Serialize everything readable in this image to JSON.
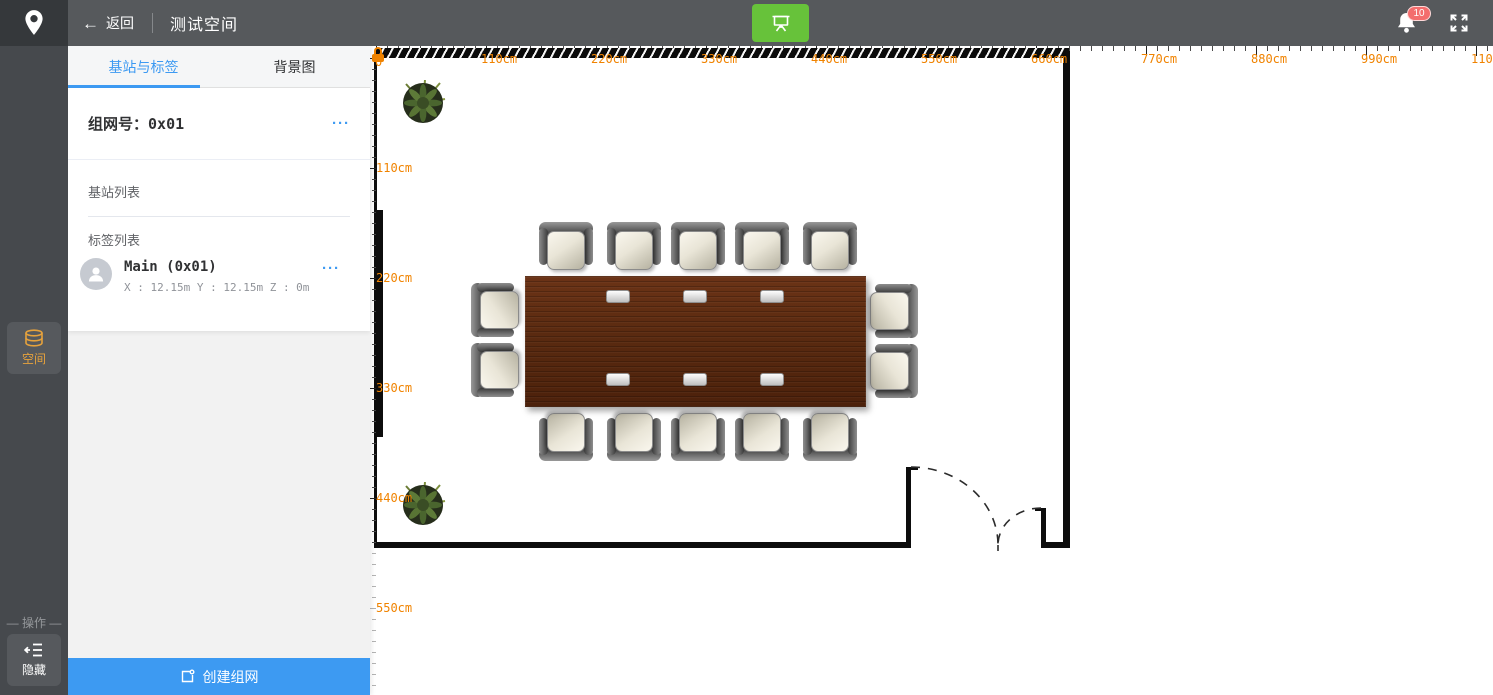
{
  "topbar": {
    "back_label": "返回",
    "title": "测试空间",
    "badge_count": "10"
  },
  "sidebar": {
    "space_label": "空间",
    "operation_label": "— 操作 —",
    "hide_label": "隐藏"
  },
  "panel": {
    "tabs": [
      {
        "label": "基站与标签",
        "active": true
      },
      {
        "label": "背景图",
        "active": false
      }
    ],
    "network_label": "组网号：",
    "network_value": "0x01",
    "menu_ellipsis": "···",
    "station_list_label": "基站列表",
    "tag_list_label": "标签列表",
    "tags": [
      {
        "name": "Main (0x01)",
        "coords": "X : 12.15m Y : 12.15m Z : 0m"
      }
    ],
    "create_button_label": "创建组网"
  },
  "colors": {
    "accent_blue": "#3d9af2",
    "sidebar_orange": "#e6a23c",
    "ruler_orange": "#f08300",
    "success_green": "#67c23a",
    "badge_red": "#f36d6d"
  },
  "floorplan": {
    "origin": {
      "x": 6,
      "y": 12,
      "label": "0"
    },
    "ruler": {
      "minor_px": 11,
      "major_every": 10,
      "step_cm": 110,
      "px_per_cm": 1,
      "h_labels": [
        "110cm",
        "220cm",
        "330cm",
        "440cm",
        "550cm",
        "660cm",
        "770cm",
        "880cm",
        "990cm",
        "1100cm"
      ],
      "v_labels": [
        "110cm",
        "220cm",
        "330cm",
        "440cm",
        "550cm"
      ]
    },
    "room_bottom_y": 502,
    "walls": [
      {
        "name": "wall-top-hatched",
        "x": 6,
        "y": 2,
        "w": 690,
        "h": 10,
        "hatch": true
      },
      {
        "name": "wall-left",
        "x": 4,
        "y": 12,
        "w": 3,
        "h": 490
      },
      {
        "name": "wall-left-thick-segment",
        "x": 4,
        "y": 164,
        "w": 9,
        "h": 227
      },
      {
        "name": "wall-right",
        "x": 693,
        "y": 2,
        "w": 7,
        "h": 500
      },
      {
        "name": "wall-bottom-left",
        "x": 4,
        "y": 496,
        "w": 537,
        "h": 6
      },
      {
        "name": "wall-bottom-right",
        "x": 671,
        "y": 496,
        "w": 29,
        "h": 6
      },
      {
        "name": "door-jamb-left",
        "x": 536,
        "y": 421,
        "w": 5,
        "h": 81
      },
      {
        "name": "door-jamb-left-cap",
        "x": 536,
        "y": 421,
        "w": 12,
        "h": 3
      },
      {
        "name": "door-jamb-right",
        "x": 671,
        "y": 462,
        "w": 5,
        "h": 40
      },
      {
        "name": "door-jamb-right-cap",
        "x": 665,
        "y": 462,
        "w": 11,
        "h": 3
      }
    ],
    "door_paths": [
      "M 541 421 A 87 78 0 0 1 628 499",
      "M 671 462 A 43 37 0 0 0 628 499",
      "M 628 499 L 628 505"
    ],
    "table": {
      "x": 155,
      "y": 230,
      "w": 341,
      "h": 131,
      "grommets": [
        {
          "x": 81,
          "y": 14
        },
        {
          "x": 158,
          "y": 14
        },
        {
          "x": 235,
          "y": 14
        },
        {
          "x": 81,
          "y": 97
        },
        {
          "x": 158,
          "y": 97
        },
        {
          "x": 235,
          "y": 97
        }
      ]
    },
    "chairs": [
      {
        "cx": 196,
        "cy": 200,
        "dir": 0
      },
      {
        "cx": 264,
        "cy": 200,
        "dir": 0
      },
      {
        "cx": 328,
        "cy": 200,
        "dir": 0
      },
      {
        "cx": 392,
        "cy": 200,
        "dir": 0
      },
      {
        "cx": 460,
        "cy": 200,
        "dir": 0
      },
      {
        "cx": 196,
        "cy": 391,
        "dir": 180
      },
      {
        "cx": 264,
        "cy": 391,
        "dir": 180
      },
      {
        "cx": 328,
        "cy": 391,
        "dir": 180
      },
      {
        "cx": 392,
        "cy": 391,
        "dir": 180
      },
      {
        "cx": 460,
        "cy": 391,
        "dir": 180
      },
      {
        "cx": 125,
        "cy": 264,
        "dir": -90
      },
      {
        "cx": 125,
        "cy": 324,
        "dir": -90
      },
      {
        "cx": 524,
        "cy": 265,
        "dir": 90
      },
      {
        "cx": 524,
        "cy": 325,
        "dir": 90
      }
    ],
    "plants": [
      {
        "cx": 53,
        "cy": 57
      },
      {
        "cx": 53,
        "cy": 459
      }
    ]
  }
}
